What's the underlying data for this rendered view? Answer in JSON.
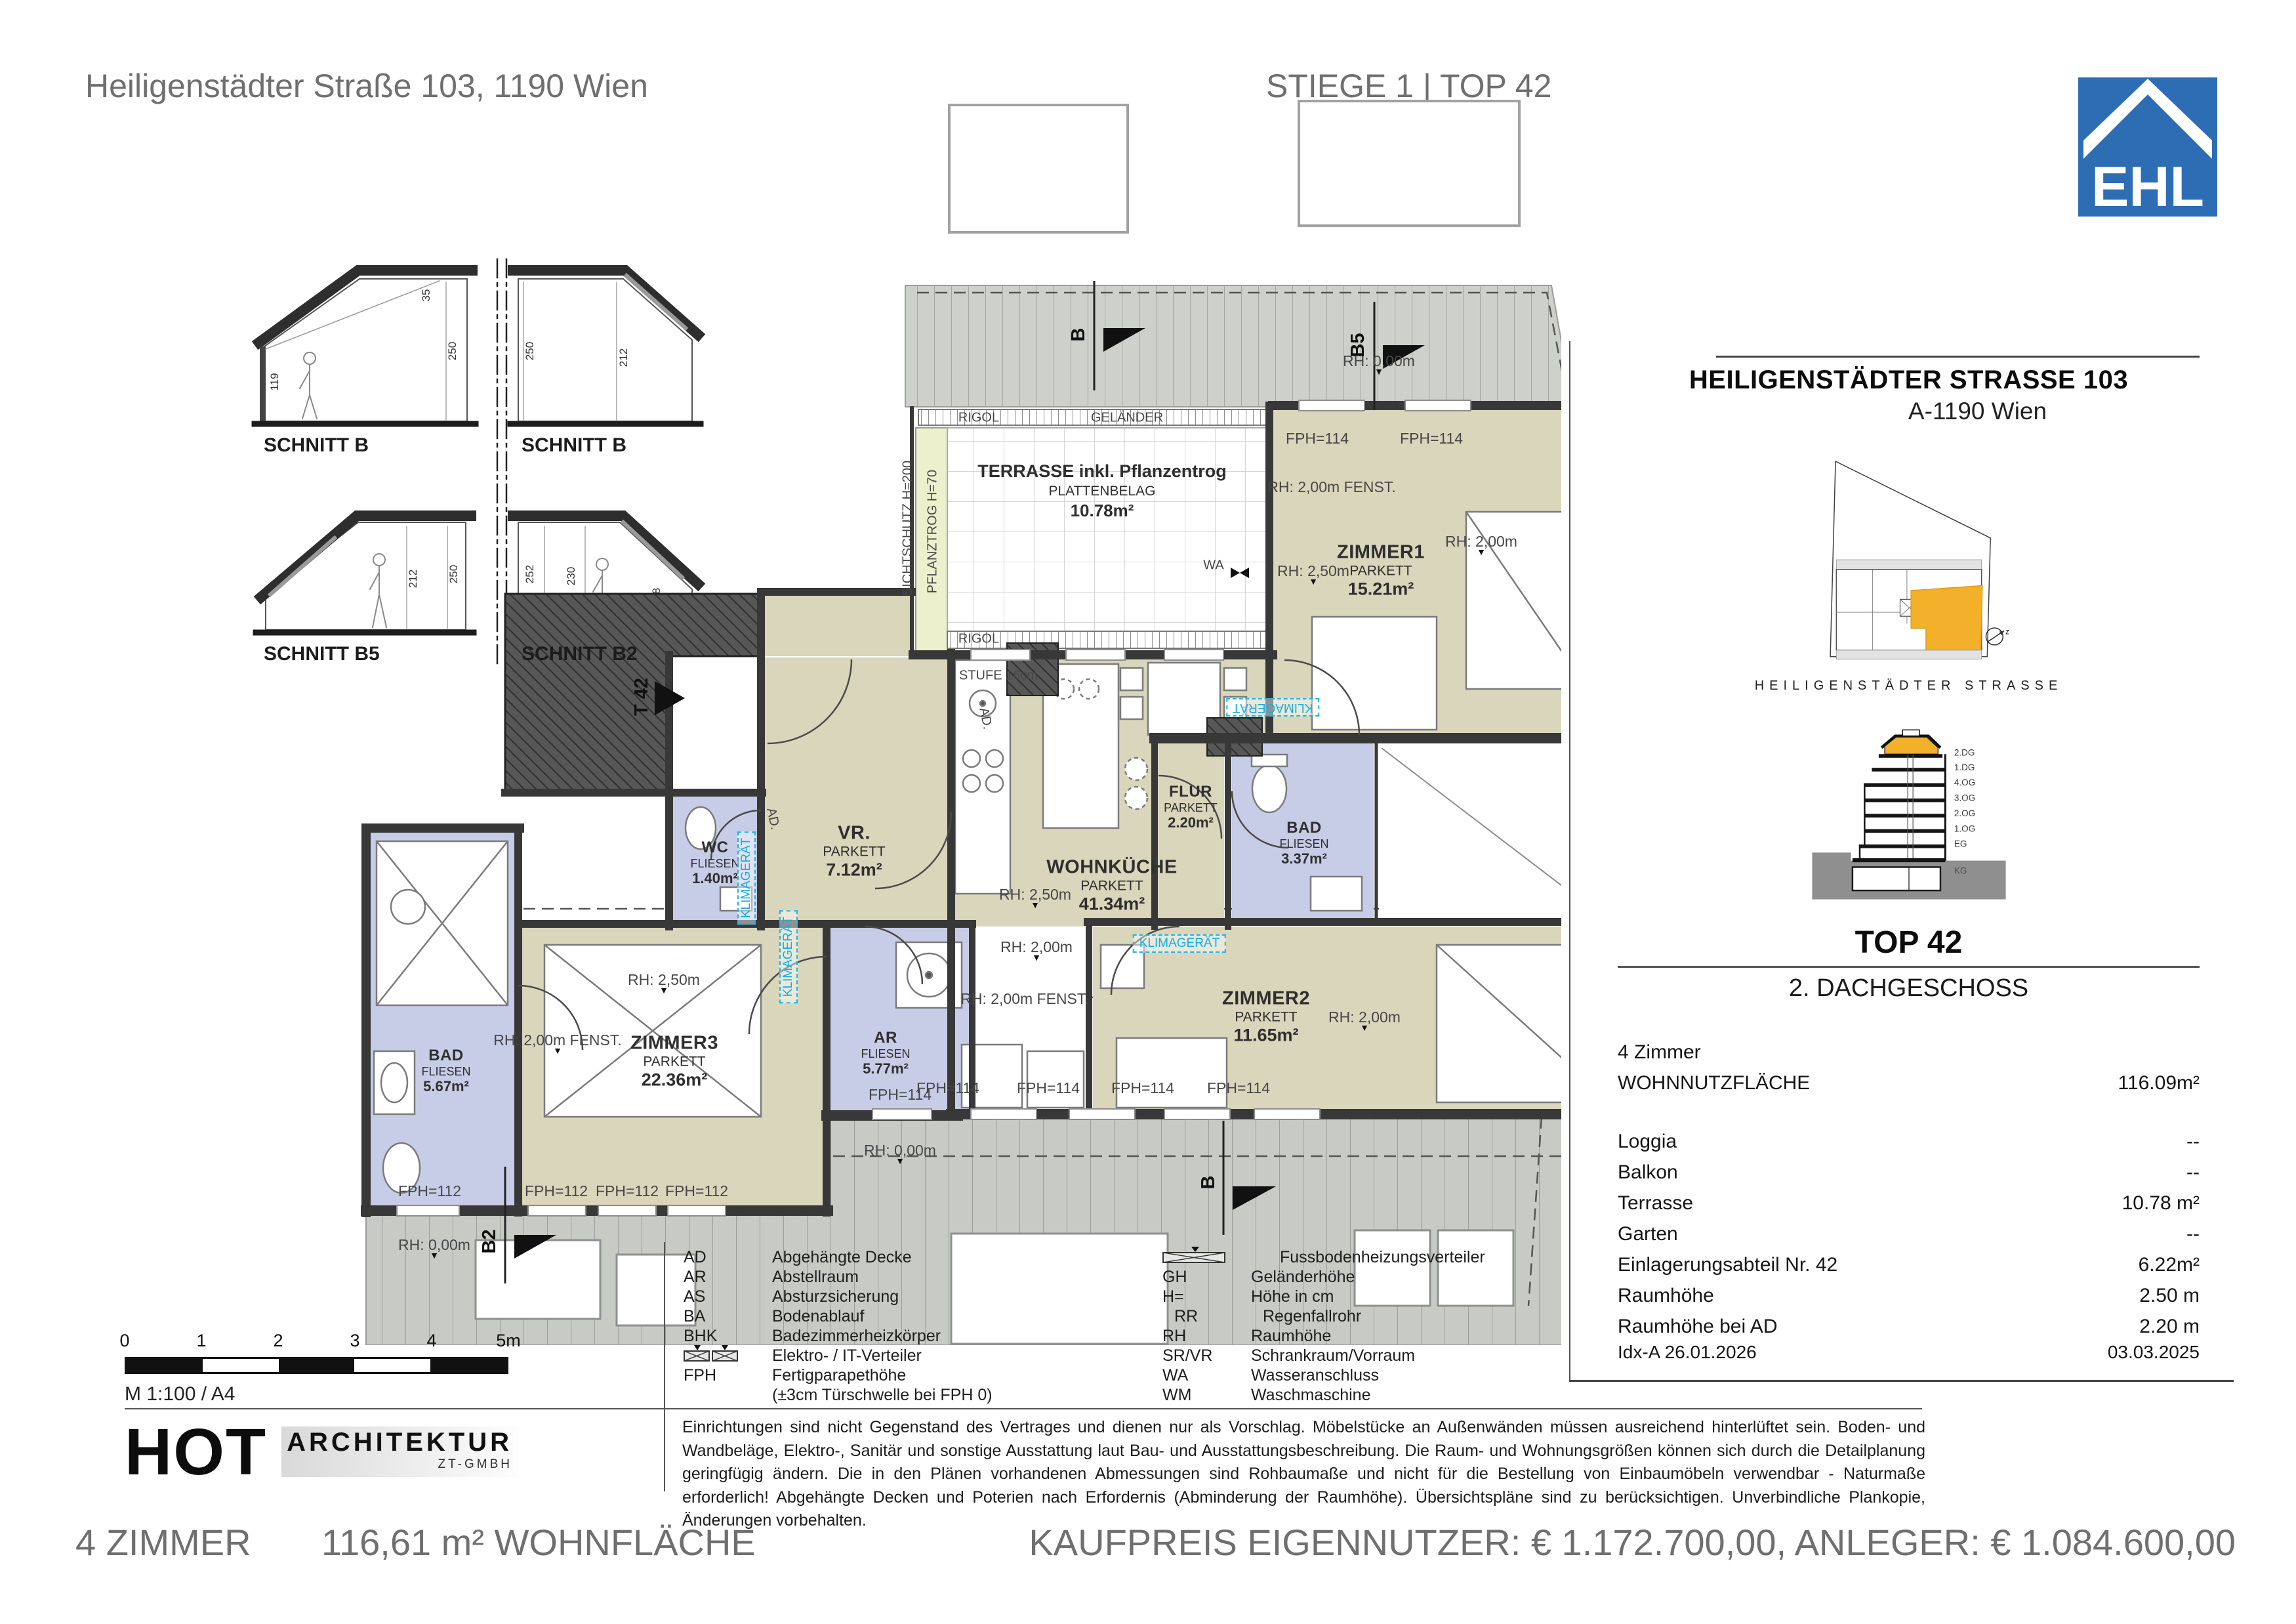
{
  "header": {
    "address": "Heiligenstädter Straße 103, 1190 Wien",
    "unit_title": "STIEGE 1 | TOP 42",
    "logo_text": "EHL"
  },
  "plan": {
    "sections": [
      {
        "label": "SCHNITT B",
        "dims": [
          "119",
          "250",
          "35"
        ]
      },
      {
        "label": "SCHNITT B",
        "dims": [
          "250",
          "212"
        ]
      },
      {
        "label": "SCHNITT B5",
        "dims": [
          "212",
          "250"
        ]
      },
      {
        "label": "SCHNITT B2",
        "dims": [
          "252",
          "230",
          "148"
        ]
      }
    ],
    "terrace": {
      "line1": "TERRASSE inkl. Pflanzentrog",
      "line2": "PLATTENBELAG",
      "area": "10.78m²"
    },
    "rooms": [
      {
        "name": "WOHNKÜCHE",
        "floor": "PARKETT",
        "area": "41.34m²"
      },
      {
        "name": "ZIMMER1",
        "floor": "PARKETT",
        "area": "15.21m²"
      },
      {
        "name": "ZIMMER2",
        "floor": "PARKETT",
        "area": "11.65m²"
      },
      {
        "name": "ZIMMER3",
        "floor": "PARKETT",
        "area": "22.36m²"
      },
      {
        "name": "VR.",
        "floor": "PARKETT",
        "area": "7.12m²"
      },
      {
        "name": "FLUR",
        "floor": "PARKETT",
        "area": "2.20m²"
      },
      {
        "name": "BAD",
        "floor": "FLIESEN",
        "area": "3.37m²"
      },
      {
        "name": "BAD",
        "floor": "FLIESEN",
        "area": "5.67m²"
      },
      {
        "name": "WC",
        "floor": "FLIESEN",
        "area": "1.40m²"
      },
      {
        "name": "AR",
        "floor": "FLIESEN",
        "area": "5.77m²"
      }
    ],
    "annotations": {
      "rigol": "RIGOL",
      "gelaender": "GELÄNDER",
      "sichtschutz": "SICHTSCHUTZ  H=200",
      "pflanztrog": "PFLANZTROG  H=70",
      "wa": "WA",
      "stufe": "STUFE 16cm",
      "fph114": "FPH=114",
      "fph112": "FPH=112",
      "rh250": "RH: 2,50m",
      "rh200": "RH: 2,00m",
      "rh200f": "RH: 2,00m  FENST.",
      "rh000": "RH: 0,00m",
      "klima": "KLIMAGERÄT",
      "ad": "AD.",
      "t42": "T 42",
      "b": "B",
      "b5": "B5",
      "b2": "B2"
    }
  },
  "scalebar": {
    "ticks": [
      "0",
      "1",
      "2",
      "3",
      "4",
      "5m"
    ],
    "scale_note": "M 1:100 / A4"
  },
  "architect": {
    "name": "HOT",
    "line1": "ARCHITEKTUR",
    "line2": "ZT-GMBH"
  },
  "legend": {
    "left": [
      {
        "abbr": "AD",
        "term": "Abgehängte Decke"
      },
      {
        "abbr": "AR",
        "term": "Abstellraum"
      },
      {
        "abbr": "AS",
        "term": "Absturzsicherung"
      },
      {
        "abbr": "BA",
        "term": "Bodenablauf"
      },
      {
        "abbr": "BHK",
        "term": "Badezimmerheizkörper"
      },
      {
        "abbr": "",
        "term": "Elektro- / IT-Verteiler"
      },
      {
        "abbr": "FPH",
        "term": "Fertigparapethöhe"
      },
      {
        "abbr": "",
        "term": "(±3cm Türschwelle bei FPH 0)"
      }
    ],
    "right": [
      {
        "abbr": "",
        "term": "Fussbodenheizungsverteiler"
      },
      {
        "abbr": "GH",
        "term": "Geländerhöhe"
      },
      {
        "abbr": "H=",
        "term": "Höhe in cm"
      },
      {
        "abbr": "RR",
        "term": "Regenfallrohr"
      },
      {
        "abbr": "RH",
        "term": "Raumhöhe"
      },
      {
        "abbr": "SR/VR",
        "term": "Schrankraum/Vorraum"
      },
      {
        "abbr": "WA",
        "term": "Wasseranschluss"
      },
      {
        "abbr": "WM",
        "term": "Waschmaschine"
      }
    ]
  },
  "disclaimer": "Einrichtungen sind nicht Gegenstand des Vertrages und dienen nur als Vorschlag. Möbelstücke an Außenwänden müssen ausreichend hinterlüftet sein. Boden- und Wandbeläge, Elektro-, Sanitär und sonstige Ausstattung laut Bau- und Ausstattungsbeschreibung. Die Raum- und Wohnungsgrößen können sich durch die Detailplanung geringfügig ändern. Die in den Plänen vorhandenen Abmessungen sind Rohbaumaße und nicht für die Bestellung von Einbaumöbeln verwendbar - Naturmaße erforderlich! Abgehängte Decken und Poterien nach Erfordernis (Abminderung der Raumhöhe). Übersichtspläne sind zu berücksichtigen. Unverbindliche Plankopie, Änderungen vorbehalten.",
  "sidebar": {
    "title": "HEILIGENSTÄDTER STRASSE 103",
    "subtitle": "A-1190 Wien",
    "street_label": "HEILIGENSTÄDTER STRASSE",
    "compass_label": "z",
    "floors": [
      "2.DG",
      "1.DG",
      "4.OG",
      "3.OG",
      "2.OG",
      "1.OG",
      "EG",
      "KG"
    ],
    "top_label": "TOP 42",
    "floor_name": "2. DACHGESCHOSS",
    "details": [
      {
        "label": "4 Zimmer",
        "value": ""
      },
      {
        "label": "WOHNNUTZFLÄCHE",
        "value": "116.09m²"
      },
      {
        "label": "Loggia",
        "value": "--"
      },
      {
        "label": "Balkon",
        "value": "--"
      },
      {
        "label": "Terrasse",
        "value": "10.78 m²"
      },
      {
        "label": "Garten",
        "value": "--"
      },
      {
        "label": "Einlagerungsabteil Nr. 42",
        "value": "6.22m²"
      },
      {
        "label": "Raumhöhe",
        "value": "2.50 m"
      },
      {
        "label": "Raumhöhe bei AD",
        "value": "2.20 m"
      }
    ],
    "date_left": "Idx-A 26.01.2026",
    "date_right": "03.03.2025"
  },
  "footer": {
    "rooms": "4 ZIMMER",
    "area": "116,61 m² WOHNFLÄCHE",
    "price": "KAUFPREIS EIGENNUTZER: € 1.172.700,00, ANLEGER: € 1.084.600,00"
  }
}
